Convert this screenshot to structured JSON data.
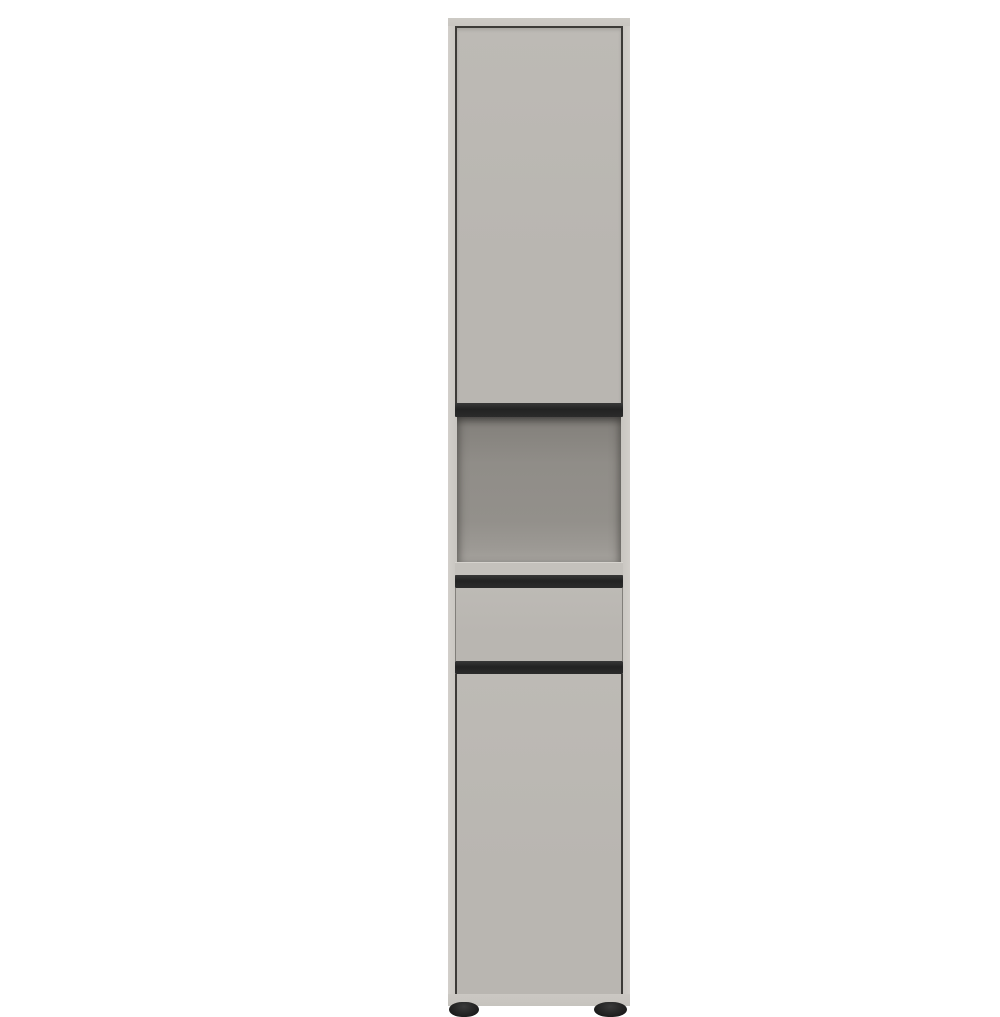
{
  "scene": {
    "type": "product-photo",
    "background_color": "#ffffff"
  },
  "cabinet": {
    "label": "tall-storage-cabinet",
    "description": "Freestanding tall narrow storage cabinet in matte grey-beige (taupe) with an upper door, an open shelf niche, one drawer, a lower door, recessed black handle strips and two black round feet",
    "colors": {
      "carcass": "#c8c5c0",
      "carcass_edge": "#d2cfca",
      "front": "#b9b6b1",
      "front_highlight": "#bdbab5",
      "seam": "#3c3a37",
      "handle_dark": "#222222",
      "handle_mid": "#383838",
      "niche_back": "#908d88",
      "niche_shadow": "#6e6b67",
      "niche_floor": "#a5a29d",
      "shelf_edge": "#c4c1bc",
      "plinth": "#c6c3be",
      "foot": "#1c1c1c",
      "background": "#ffffff"
    },
    "parts": [
      {
        "id": "carcass",
        "label": "cabinet carcass / outer frame"
      },
      {
        "id": "top-lip",
        "label": "top panel edge"
      },
      {
        "id": "top-door",
        "label": "upper door"
      },
      {
        "id": "top-door-handle",
        "label": "upper door recessed handle strip"
      },
      {
        "id": "open-niche",
        "label": "open shelf niche"
      },
      {
        "id": "shelf-edge",
        "label": "shelf front edge"
      },
      {
        "id": "drawer-handle",
        "label": "drawer recessed handle strip"
      },
      {
        "id": "drawer-front",
        "label": "drawer front"
      },
      {
        "id": "bottom-door-handle",
        "label": "lower door recessed handle strip"
      },
      {
        "id": "bottom-door",
        "label": "lower door"
      },
      {
        "id": "plinth",
        "label": "plinth"
      },
      {
        "id": "foot-left",
        "label": "left foot"
      },
      {
        "id": "foot-right",
        "label": "right foot"
      }
    ]
  }
}
